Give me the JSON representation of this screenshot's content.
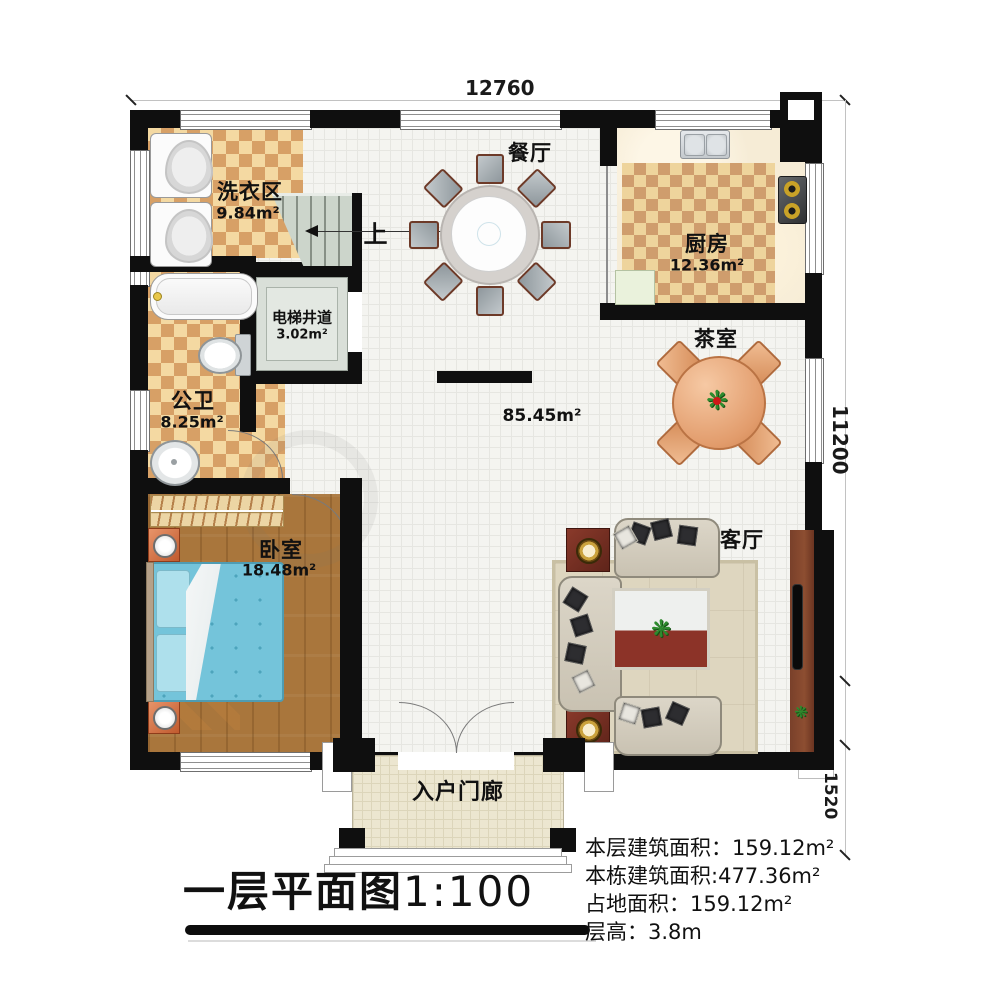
{
  "title": {
    "main": "一层平面图",
    "scale": "1:100"
  },
  "dimensions": {
    "top_width": "12760",
    "right_height": "11200",
    "right_bump": "800",
    "right_porch": "1520"
  },
  "stair": {
    "up_label": "上"
  },
  "rooms": {
    "laundry": {
      "name": "洗衣区",
      "area": "9.84m²"
    },
    "dining": {
      "name": "餐厅"
    },
    "kitchen": {
      "name": "厨房",
      "area": "12.36m²"
    },
    "elevator": {
      "name": "电梯井道",
      "area": "3.02m²"
    },
    "bathroom": {
      "name": "公卫",
      "area": "8.25m²"
    },
    "hall": {
      "area": "85.45m²"
    },
    "tea": {
      "name": "茶室"
    },
    "bedroom": {
      "name": "卧室",
      "area": "18.48m²"
    },
    "living": {
      "name": "客厅"
    },
    "porch": {
      "name": "入户门廊"
    }
  },
  "stats": [
    {
      "label": "本层建筑面积：",
      "value": "159.12m²"
    },
    {
      "label": "本栋建筑面积:",
      "value": "477.36m²"
    },
    {
      "label": "占地面积：",
      "value": "159.12m²"
    },
    {
      "label": "层高：",
      "value": "3.8m"
    }
  ],
  "colors": {
    "wall": "#0f0f0f",
    "checker_dark": "#d7a066",
    "checker_light": "#f4d9a2",
    "wood": "#a9763c",
    "bed": "#74c4da",
    "tea_table": "#e9a87f",
    "accent_red": "#7e2f26"
  }
}
